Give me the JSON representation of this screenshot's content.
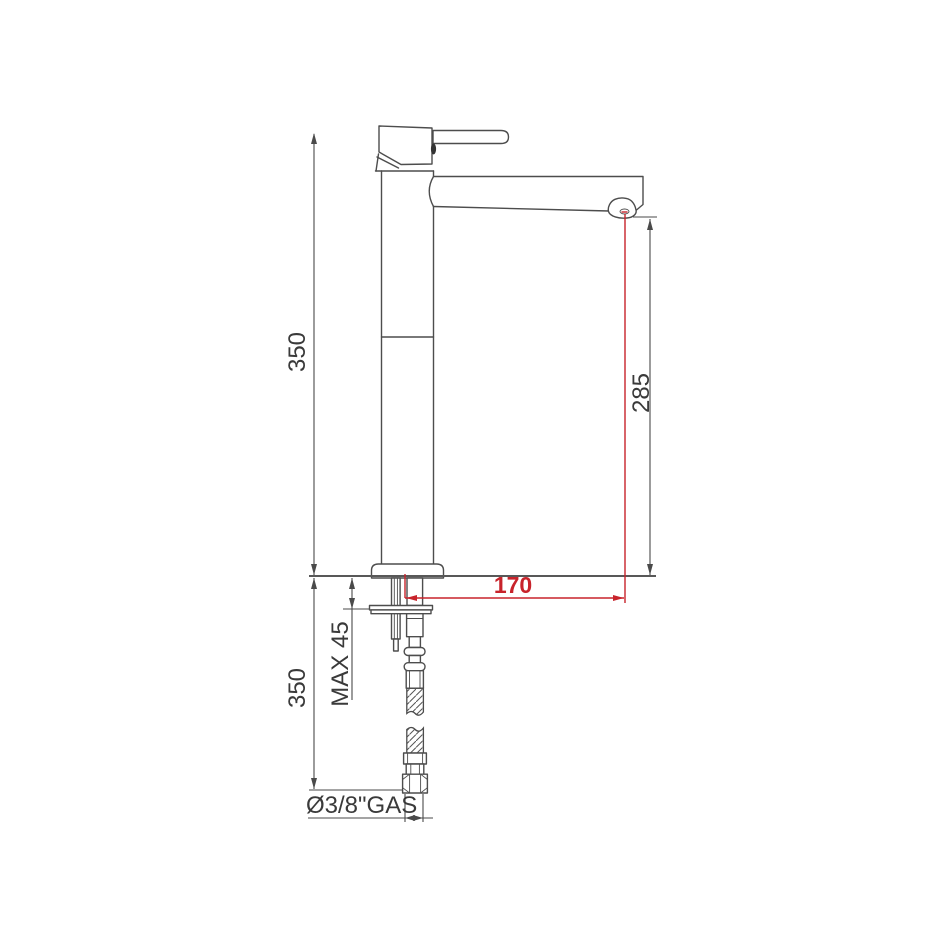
{
  "figure": {
    "type": "technical-dimension-drawing",
    "subject": "tall-single-lever-basin-mixer-side-view"
  },
  "labels": {
    "upper_height": "350",
    "lower_height": "350",
    "spout_height": "285",
    "spout_reach": "170",
    "max_deck_thickness": "MAX 45",
    "supply_connection": "Ø3/8\"GAS"
  },
  "colors": {
    "outline": "#4d4d4d",
    "dimension": "#4a4a4a",
    "accent_red": "#c8232b",
    "deck": "#585858",
    "bg": "#ffffff"
  }
}
